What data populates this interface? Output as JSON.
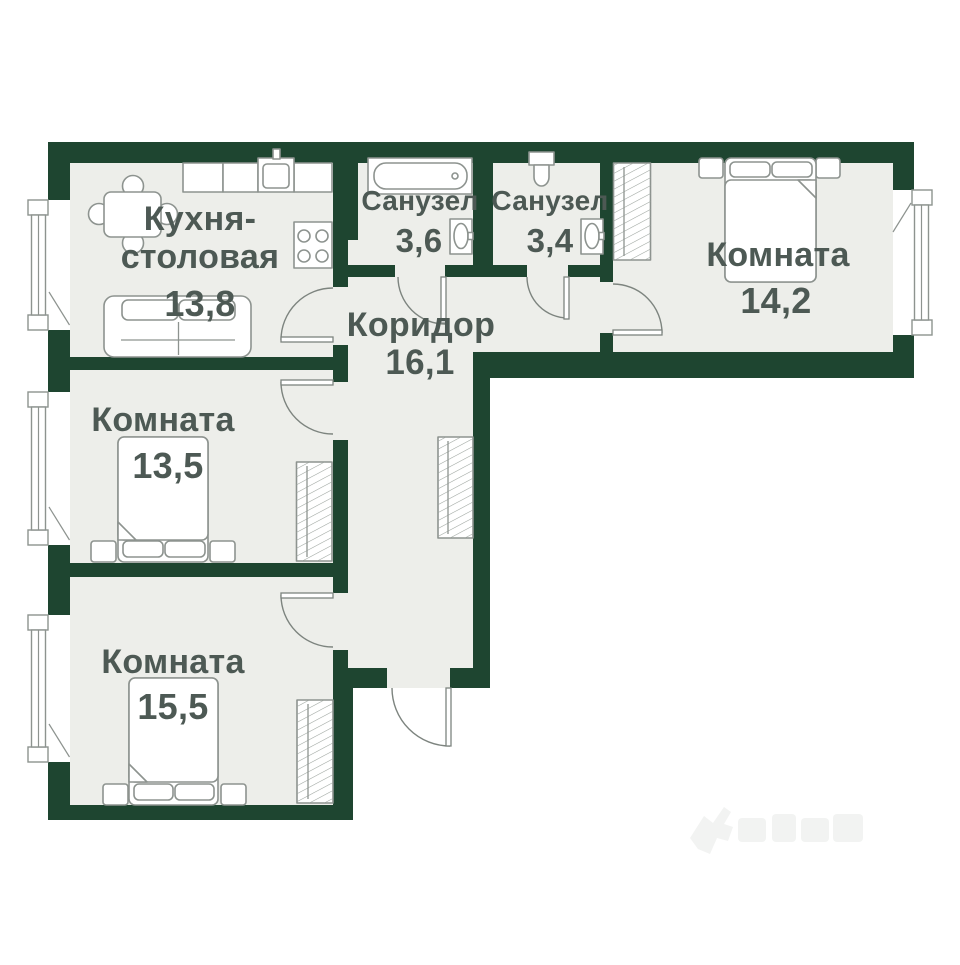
{
  "colors": {
    "wall": "#1e4530",
    "floor": "#edeeea",
    "furniture_outline": "#8d938f",
    "label_text": "#4d5954",
    "door_line": "#7d847f",
    "background": "#ffffff"
  },
  "plan": {
    "type": "apartment-floor-plan",
    "rooms": [
      {
        "id": "kitchen-dining",
        "label_line1": "Кухня-",
        "label_line2": "столовая",
        "area": "13,8",
        "furniture": [
          "dining-table",
          "chairs",
          "kitchen-counter",
          "kitchen-sink",
          "stove",
          "sofa",
          "window"
        ]
      },
      {
        "id": "bathroom-1",
        "label": "Санузел",
        "area": "3,6",
        "furniture": [
          "bathtub",
          "washbasin"
        ]
      },
      {
        "id": "bathroom-2",
        "label": "Санузел",
        "area": "3,4",
        "furniture": [
          "toilet",
          "washbasin"
        ]
      },
      {
        "id": "bedroom-right",
        "label": "Комната",
        "area": "14,2",
        "furniture": [
          "double-bed",
          "nightstands",
          "wardrobe",
          "window"
        ]
      },
      {
        "id": "corridor",
        "label": "Коридор",
        "area": "16,1",
        "furniture": [
          "wardrobe",
          "entrance-door"
        ]
      },
      {
        "id": "bedroom-middle",
        "label": "Комната",
        "area": "13,5",
        "furniture": [
          "double-bed",
          "nightstands",
          "wardrobe",
          "window"
        ]
      },
      {
        "id": "bedroom-bottom",
        "label": "Комната",
        "area": "15,5",
        "furniture": [
          "double-bed",
          "nightstands",
          "wardrobe",
          "window"
        ]
      }
    ]
  }
}
